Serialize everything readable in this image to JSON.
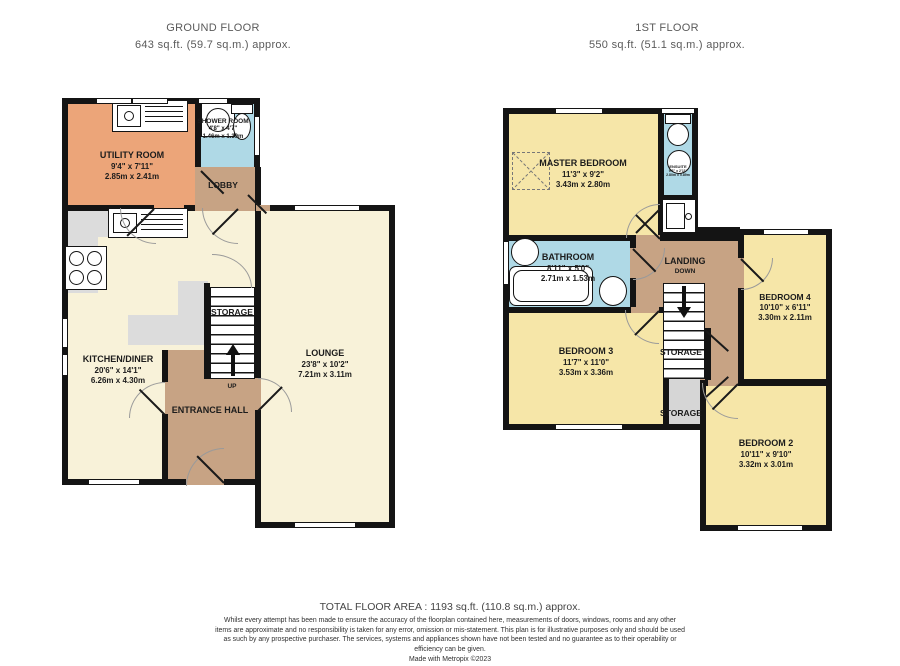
{
  "header": {
    "ground": {
      "title": "GROUND FLOOR",
      "area": "643 sq.ft. (59.7 sq.m.) approx."
    },
    "first": {
      "title": "1ST FLOOR",
      "area": "550 sq.ft. (51.1 sq.m.) approx."
    }
  },
  "ground": {
    "rooms": {
      "utility": {
        "name": "UTILITY ROOM",
        "imperial": "9'4\" x 7'11\"",
        "metric": "2.85m x 2.41m"
      },
      "shower": {
        "name": "SHOWER ROOM",
        "imperial": "4'8\" x 4'7\"",
        "metric": "1.46m x 1.39m"
      },
      "lobby": {
        "name": "LOBBY"
      },
      "kitchen": {
        "name": "KITCHEN/DINER",
        "imperial": "20'6\" x 14'1\"",
        "metric": "6.26m x 4.30m"
      },
      "storage": {
        "name": "STORAGE"
      },
      "up": {
        "name": "UP"
      },
      "hall": {
        "name": "ENTRANCE HALL"
      },
      "lounge": {
        "name": "LOUNGE",
        "imperial": "23'8\" x 10'2\"",
        "metric": "7.21m x 3.11m"
      }
    }
  },
  "first": {
    "rooms": {
      "master": {
        "name": "MASTER BEDROOM",
        "imperial": "11'3\" x 9'2\"",
        "metric": "3.43m x 2.80m"
      },
      "ensuite": {
        "name": "ENSUITE",
        "imperial": "9'2\" x 2'11\"",
        "metric": "2.80m x 0.89m"
      },
      "bathroom": {
        "name": "BATHROOM",
        "imperial": "8'11\" x 5'0\"",
        "metric": "2.71m x 1.53m"
      },
      "landing": {
        "name": "LANDING",
        "down": "DOWN"
      },
      "bedroom4": {
        "name": "BEDROOM 4",
        "imperial": "10'10\" x 6'11\"",
        "metric": "3.30m x 2.11m"
      },
      "bedroom3": {
        "name": "BEDROOM 3",
        "imperial": "11'7\" x 11'0\"",
        "metric": "3.53m x 3.36m"
      },
      "storage_stairs": {
        "name": "STORAGE"
      },
      "storage": {
        "name": "STORAGE"
      },
      "bedroom2": {
        "name": "BEDROOM 2",
        "imperial": "10'11\" x 9'10\"",
        "metric": "3.32m x 3.01m"
      }
    }
  },
  "footer": {
    "total": "TOTAL FLOOR AREA : 1193 sq.ft. (110.8 sq.m.) approx.",
    "disclaimer": "Whilst every attempt has been made to ensure the accuracy of the floorplan contained here, measurements of doors, windows, rooms and any other items are approximate and no responsibility is taken for any error, omission or mis-statement. This plan is for illustrative purposes only and should be used as such by any prospective purchaser. The services, systems and appliances shown have not been tested and no guarantee as to their operability or efficiency can be given.",
    "credit": "Made with Metropix ©2023"
  },
  "palette": {
    "wall": "#141414",
    "cream": "#F8F2D9",
    "bedroom_yellow": "#F6E6A8",
    "wet_blue": "#AFD9E6",
    "hall_tan": "#C7A384",
    "utility_orange": "#ECA579",
    "counter_gray": "#DCDCDC",
    "storage_gray": "#D6D6D6"
  }
}
